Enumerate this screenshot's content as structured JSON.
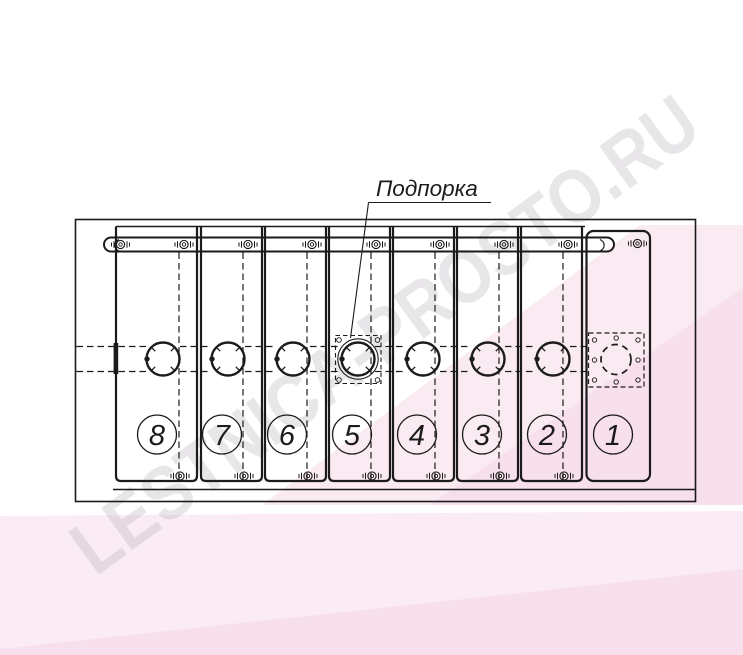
{
  "page": {
    "background": "#ffffff"
  },
  "watermark": {
    "text": "LESTNICA-PROSTO.RU"
  },
  "annotation": {
    "label": "Подпорка",
    "target_section": "5"
  },
  "sections": [
    {
      "number": "8"
    },
    {
      "number": "7"
    },
    {
      "number": "6"
    },
    {
      "number": "5"
    },
    {
      "number": "4"
    },
    {
      "number": "3"
    },
    {
      "number": "2"
    },
    {
      "number": "1"
    }
  ],
  "colors": {
    "line": "#1b1b1b",
    "watermark_text": "rgba(184,180,188,0.33)",
    "pink_main": "rgba(243,205,224,0.42)",
    "pink_deep": "rgba(240,195,219,0.28)",
    "pink_band": "rgba(247,216,233,0.50)",
    "pink_band_deep": "rgba(243,204,226,0.40)"
  }
}
